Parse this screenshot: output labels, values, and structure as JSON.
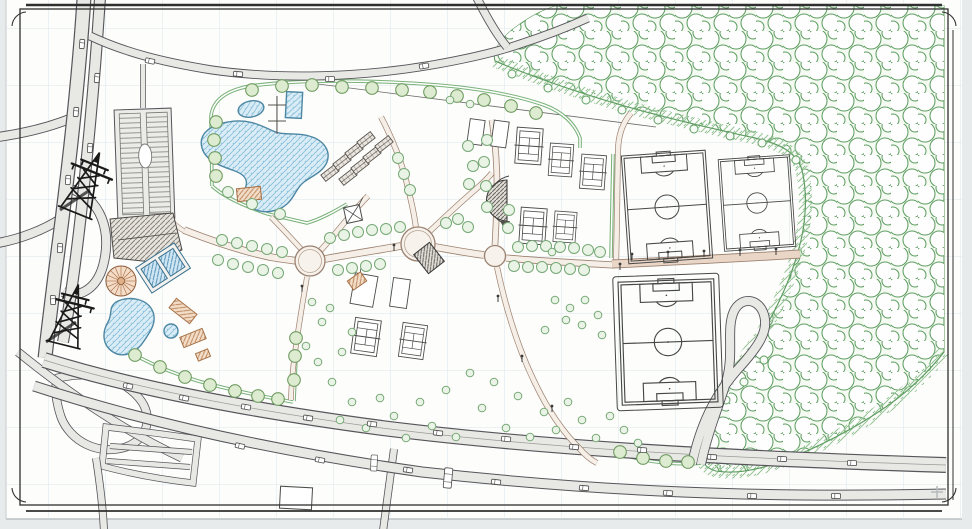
{
  "meta": {
    "document_type": "Recreational park master plan — CAD site drawing",
    "drawing_style": "black-line architectural plan with colored hatches on a white sheet with light blue grid and ornamental border frame",
    "visible_text": "none",
    "watermark": "small light plus mark near the bottom-right corner"
  },
  "palette": {
    "page": "#e8ebec",
    "sheet": "#fdfdfb",
    "grid": "#dce7ee",
    "frame": "#2f2f2f",
    "road_fill": "#e8e8e5",
    "road_casing": "#55555a",
    "path_fill": "#f6efe7",
    "path_casing": "#9b8170",
    "promenade": "#e9d6c7",
    "water": "#daedf7",
    "water_hatch": "#8abfd8",
    "water_line": "#4d87a3",
    "tree_fill": "#eaf4e6",
    "tree_line": "#76a876",
    "forest_line": "#5f9e62",
    "hedge": "#7ab27a",
    "hatch_green": "#97c497",
    "roof_gray": "#85817a",
    "roof_tan": "#c08a5f",
    "roof_blue": "#5a93b5",
    "field_line": "#474745",
    "pylon": "#1a1a1a",
    "car_fill": "#ffffff",
    "car_line": "#4a4a4a"
  },
  "features": {
    "park": [
      "free-form main swimming pool with hatched water",
      "oval splash pool",
      "rectangular lap pool with diving platform",
      "pool pavilion",
      "two rows of bungalow cabins",
      "seven tennis courts",
      "four plain practice courts",
      "semicircular bandstand stage",
      "three circular path plazas",
      "tree-lined straight promenade",
      "two training soccer fields",
      "one large fenced soccer field",
      "carousel",
      "children's pond with water slides",
      "entrance hall with hatched roof",
      "blue-roofed pavilion",
      "kiosk at central plaza",
      "square pavilion with X bracing",
      "hedge boundaries lined with trees"
    ],
    "surroundings": [
      "dense forest mass over the north-east and east",
      "motorway interchange on the west",
      "two high-voltage lattice pylons",
      "striped parking lot",
      "boulevard with car traffic along the south",
      "secondary street with traffic",
      "hairpin access road",
      "local street block in the south-west",
      "single building near the boulevard"
    ]
  },
  "counts": {
    "soccer_fields": 3,
    "tennis_courts": 7,
    "practice_courts": 4,
    "cabins": 8,
    "path_plazas": 3,
    "pools_and_ponds": 5,
    "pylons": 2,
    "cars_visible_approx": 30
  }
}
